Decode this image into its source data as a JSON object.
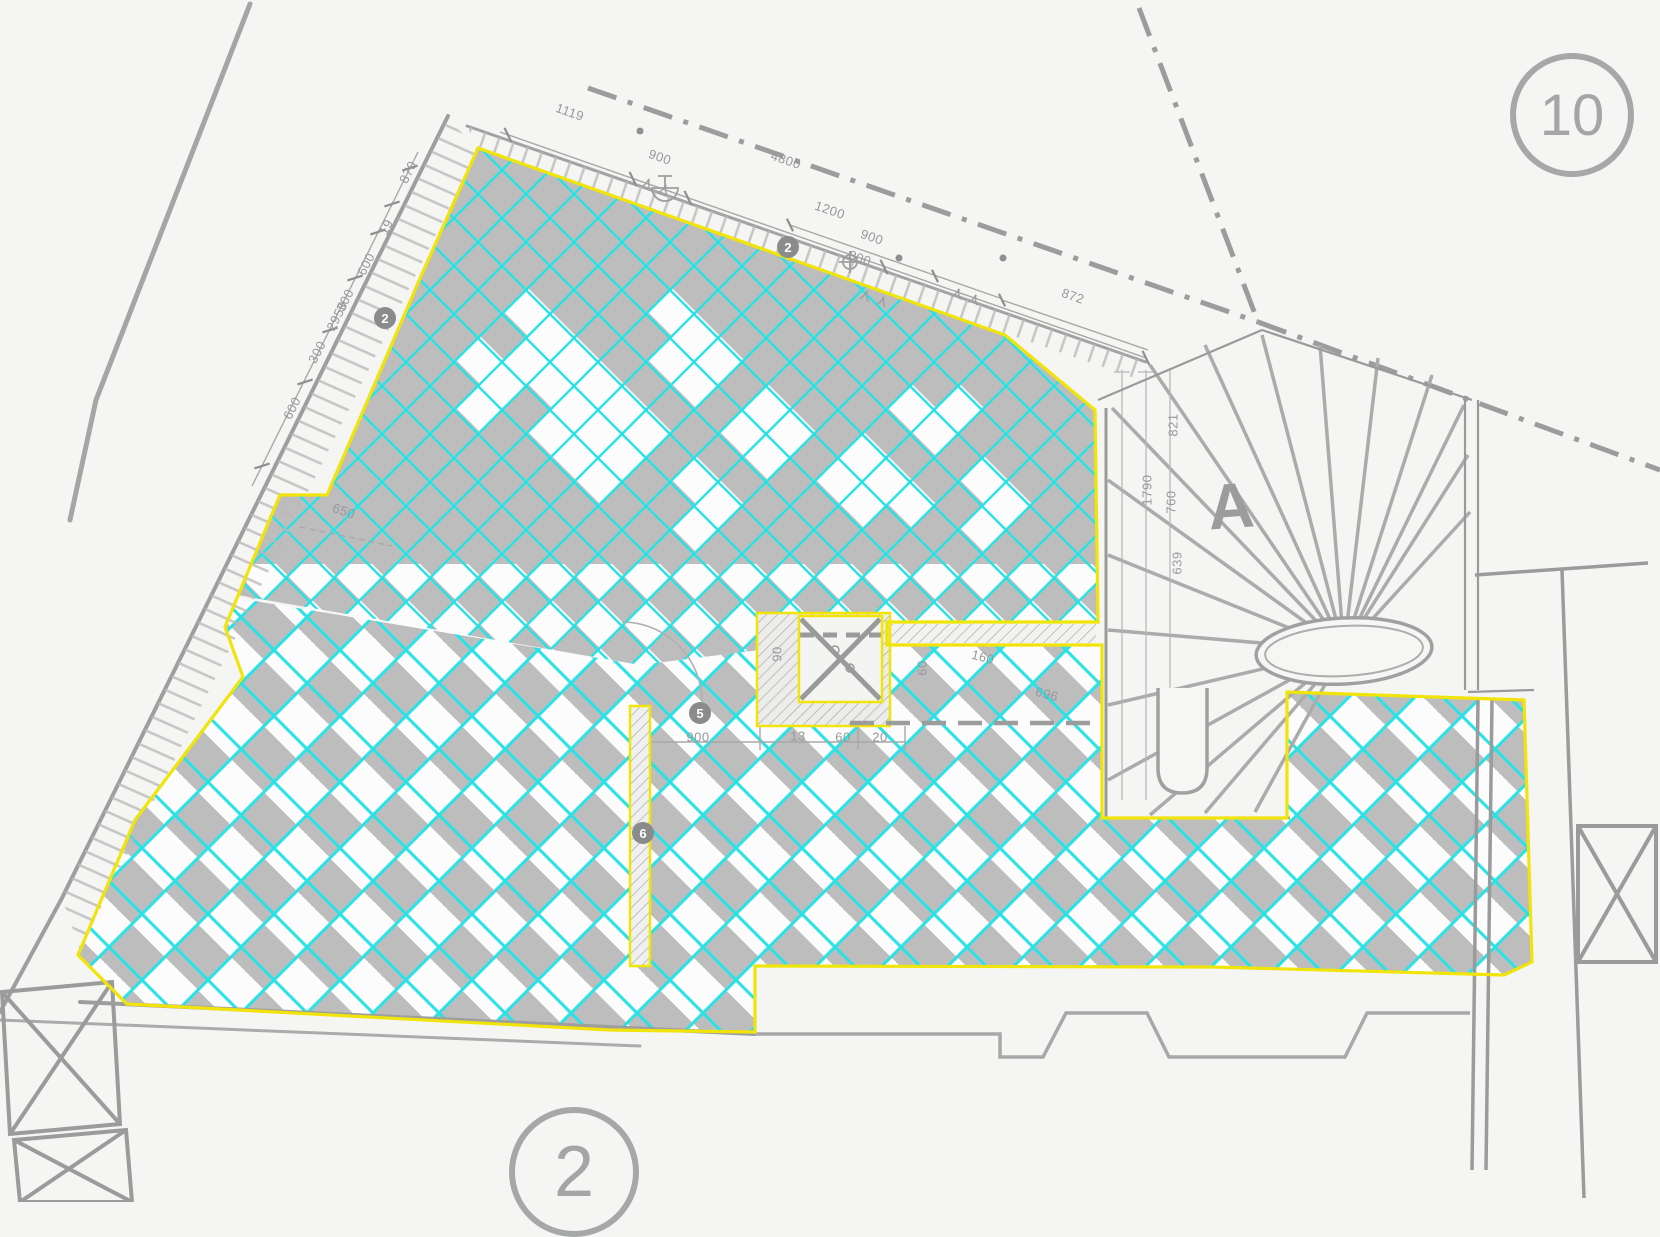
{
  "drawing": {
    "sheet_labels": [
      {
        "text": "10",
        "x": 1572,
        "y": 115,
        "d": 112,
        "font": 58
      },
      {
        "text": "2",
        "x": 574,
        "y": 1172,
        "d": 118,
        "font": 72
      }
    ],
    "stair_label": {
      "text": "A",
      "x": 1231,
      "y": 506
    },
    "keynotes": [
      {
        "text": "2",
        "x": 788,
        "y": 247
      },
      {
        "text": "2",
        "x": 385,
        "y": 318
      },
      {
        "text": "5",
        "x": 700,
        "y": 713
      },
      {
        "text": "6",
        "x": 643,
        "y": 833
      }
    ],
    "dimensions": [
      {
        "text": "1119",
        "x": 570,
        "y": 112,
        "angle": 19
      },
      {
        "text": "900",
        "x": 660,
        "y": 157,
        "angle": 19
      },
      {
        "text": "4800",
        "x": 786,
        "y": 160,
        "angle": 19
      },
      {
        "text": "1200",
        "x": 830,
        "y": 210,
        "angle": 19
      },
      {
        "text": "900",
        "x": 872,
        "y": 237,
        "angle": 19
      },
      {
        "text": "800",
        "x": 860,
        "y": 258,
        "angle": 19
      },
      {
        "text": "872",
        "x": 1073,
        "y": 296,
        "angle": 19
      },
      {
        "text": "870",
        "x": 408,
        "y": 172,
        "angle": -63
      },
      {
        "text": "19",
        "x": 386,
        "y": 227,
        "angle": -63
      },
      {
        "text": "600",
        "x": 366,
        "y": 264,
        "angle": -63
      },
      {
        "text": "300",
        "x": 345,
        "y": 300,
        "angle": -63
      },
      {
        "text": "2950",
        "x": 337,
        "y": 316,
        "angle": -63
      },
      {
        "text": "300",
        "x": 317,
        "y": 352,
        "angle": -63
      },
      {
        "text": "600",
        "x": 292,
        "y": 408,
        "angle": -63
      },
      {
        "text": "650",
        "x": 344,
        "y": 511,
        "angle": 19
      },
      {
        "text": "821",
        "x": 1173,
        "y": 425,
        "angle": -90
      },
      {
        "text": "1790",
        "x": 1147,
        "y": 490,
        "angle": -90
      },
      {
        "text": "760",
        "x": 1171,
        "y": 502,
        "angle": -90
      },
      {
        "text": "639",
        "x": 1177,
        "y": 563,
        "angle": -90
      },
      {
        "text": "900",
        "x": 698,
        "y": 737,
        "angle": 0
      },
      {
        "text": "13",
        "x": 798,
        "y": 736,
        "angle": 0
      },
      {
        "text": "60",
        "x": 843,
        "y": 737,
        "angle": 0
      },
      {
        "text": "20",
        "x": 880,
        "y": 737,
        "angle": 0
      },
      {
        "text": "90",
        "x": 777,
        "y": 654,
        "angle": -90
      },
      {
        "text": "60",
        "x": 922,
        "y": 668,
        "angle": -90
      },
      {
        "text": "160",
        "x": 983,
        "y": 657,
        "angle": 15
      },
      {
        "text": "696",
        "x": 1047,
        "y": 694,
        "angle": 15
      }
    ]
  },
  "colors": {
    "tile_gray": "#bdbdbe",
    "tile_white": "#fcfcfc",
    "grid_cyan": "#29e2e6",
    "outline_yellow": "#f0e40a",
    "line_gray": "#a6a6a6",
    "wall_gray": "#8f8f8f",
    "paper": "#f6f6f4"
  }
}
